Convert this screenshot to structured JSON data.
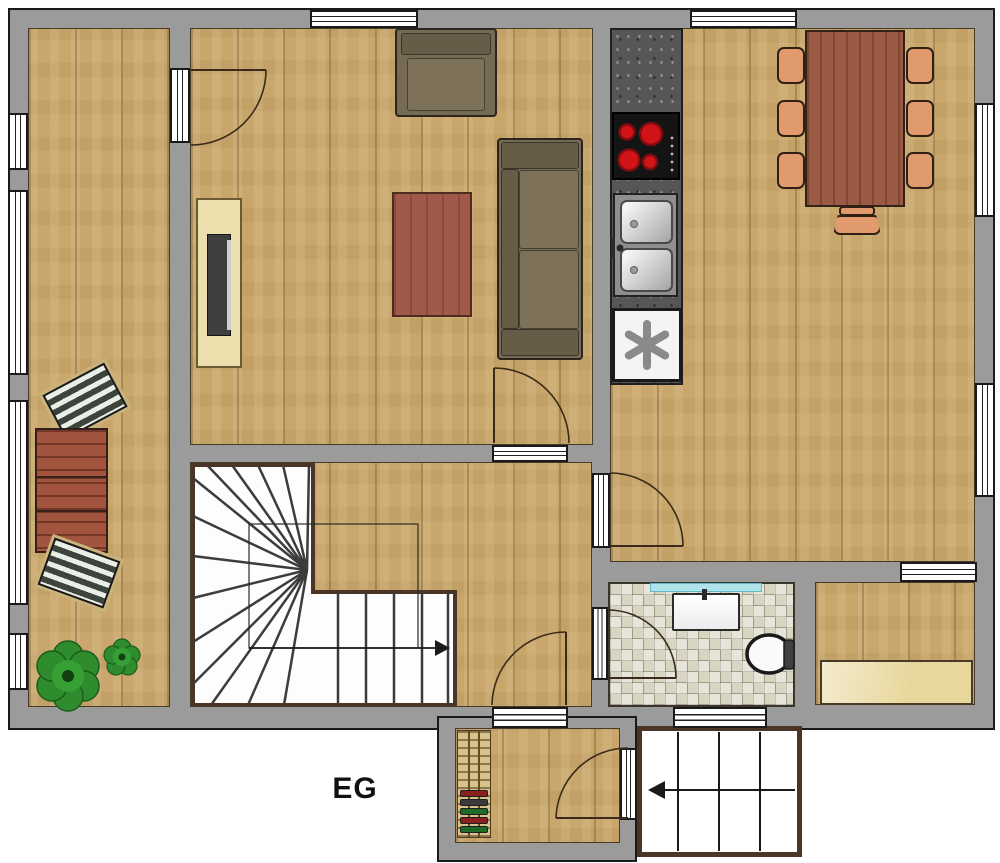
{
  "floor_label": "EG",
  "legend": {
    "stairs_up_symbol": "arrow-right",
    "entry_steps_symbol": "arrow-left",
    "freezer_symbol": "asterisk"
  },
  "colors": {
    "wall": "#9b9b9b",
    "outline": "#1a1a1a",
    "wood": "#c9a76c",
    "tile": "#d8d5c2",
    "counter": "#565656",
    "burner": "#d01418",
    "sofa": "#756b54",
    "table": "#9a5a44",
    "chair": "#e09a6d",
    "sideboard": "#ebdfad",
    "bench": "#e8d79c",
    "mirror": "#aee3ea",
    "plant": "#2e8b2e",
    "stair_border": "#4a3526"
  },
  "rooms": [
    {
      "name": "balcony"
    },
    {
      "name": "living-room"
    },
    {
      "name": "kitchen-dining"
    },
    {
      "name": "stair-hall"
    },
    {
      "name": "bathroom"
    },
    {
      "name": "storage-room"
    },
    {
      "name": "entrance"
    },
    {
      "name": "porch"
    }
  ]
}
